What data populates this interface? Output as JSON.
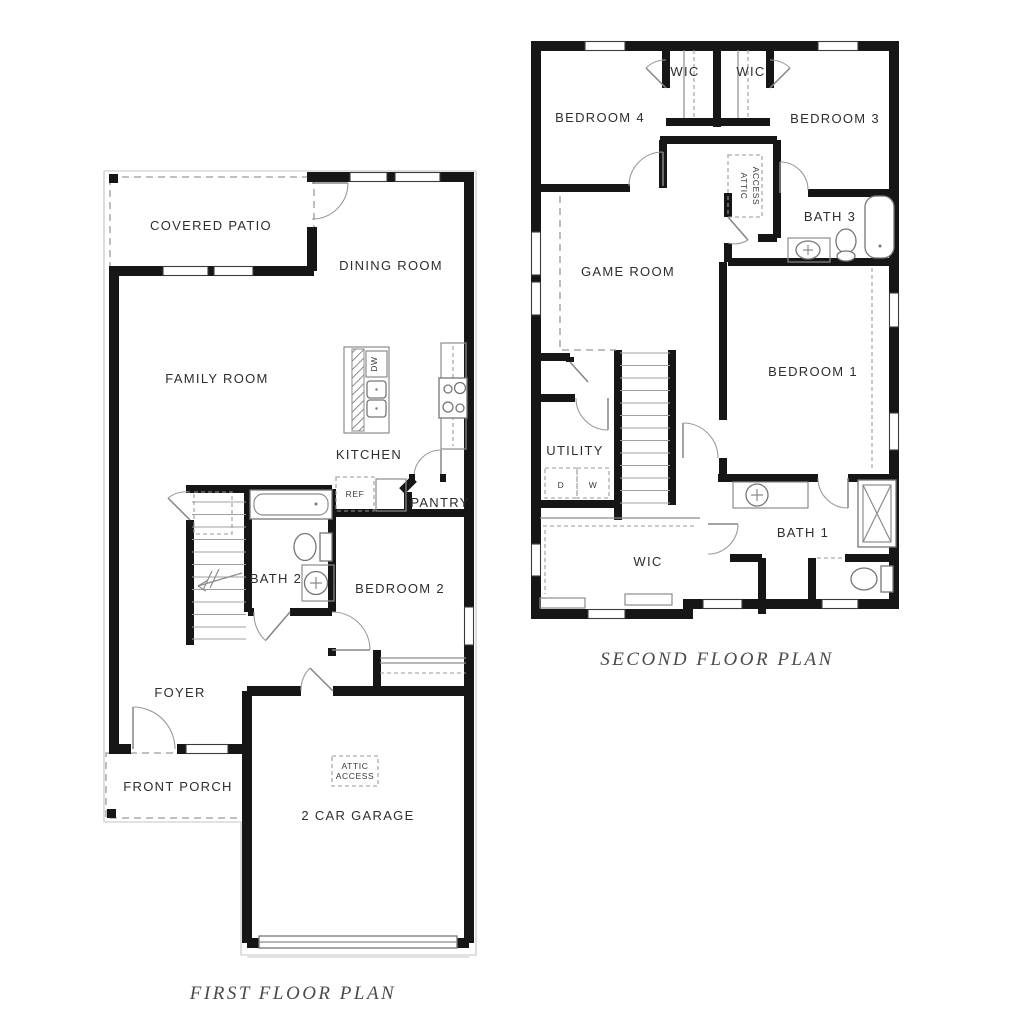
{
  "first_floor": {
    "title": "FIRST FLOOR PLAN",
    "rooms": {
      "covered_patio": "COVERED PATIO",
      "dining_room": "DINING ROOM",
      "family_room": "FAMILY ROOM",
      "kitchen": "KITCHEN",
      "pantry": "PANTRY",
      "bath_2": "BATH 2",
      "bedroom_2": "BEDROOM 2",
      "foyer": "FOYER",
      "front_porch": "FRONT PORCH",
      "garage": "2 CAR GARAGE"
    },
    "annotations": {
      "ref": "REF",
      "dishwasher": "DW",
      "attic_line1": "ATTIC",
      "attic_line2": "ACCESS"
    }
  },
  "second_floor": {
    "title": "SECOND FLOOR PLAN",
    "rooms": {
      "wic_left": "WIC",
      "wic_right": "WIC",
      "bedroom_4": "BEDROOM 4",
      "bedroom_3": "BEDROOM 3",
      "bath_3": "BATH 3",
      "game_room": "GAME ROOM",
      "bedroom_1": "BEDROOM 1",
      "utility": "UTILITY",
      "wic": "WIC",
      "bath_1": "BATH 1"
    },
    "annotations": {
      "attic_line1": "ATTIC",
      "attic_line2": "ACCESS",
      "dryer": "D",
      "washer": "W"
    }
  },
  "colors": {
    "paper": "#ffffff",
    "wall": "#161616",
    "label": "#2e2e2e",
    "title": "#4a4a4a"
  }
}
